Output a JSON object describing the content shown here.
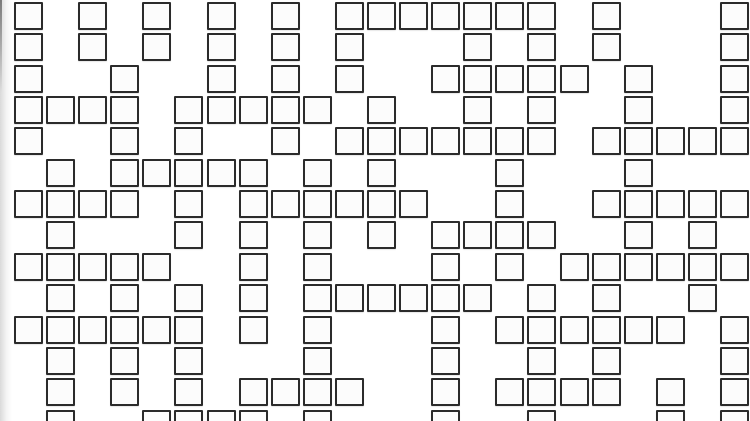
{
  "page": {
    "background_color": "#ffffff",
    "left_shadow_color": "#787878",
    "width": 750,
    "height": 421
  },
  "grid": {
    "rows": 14,
    "cols": 23,
    "origin_x": 14,
    "origin_y": 2,
    "pitch_x": 32.09,
    "pitch_y": 31.35,
    "cell_width": 29,
    "cell_height": 28,
    "border_width": 2,
    "border_color": "#2b2b2b",
    "cell_fill": "#fcfcfc",
    "cells_by_row": [
      [
        0,
        2,
        4,
        6,
        8,
        10,
        11,
        12,
        13,
        14,
        15,
        16,
        18,
        22
      ],
      [
        0,
        2,
        4,
        6,
        8,
        10,
        14,
        16,
        18,
        22
      ],
      [
        0,
        3,
        6,
        8,
        10,
        13,
        14,
        15,
        16,
        17,
        19,
        22
      ],
      [
        0,
        1,
        2,
        3,
        5,
        6,
        7,
        8,
        9,
        11,
        14,
        16,
        19,
        22
      ],
      [
        0,
        3,
        5,
        8,
        10,
        11,
        12,
        13,
        14,
        15,
        16,
        18,
        19,
        20,
        21,
        22
      ],
      [
        1,
        3,
        4,
        5,
        6,
        7,
        9,
        11,
        15,
        19
      ],
      [
        0,
        1,
        2,
        3,
        5,
        7,
        8,
        9,
        10,
        11,
        12,
        15,
        18,
        19,
        20,
        21,
        22
      ],
      [
        1,
        5,
        7,
        9,
        11,
        13,
        14,
        15,
        16,
        19,
        21
      ],
      [
        0,
        1,
        2,
        3,
        4,
        7,
        9,
        13,
        15,
        17,
        18,
        19,
        20,
        21,
        22
      ],
      [
        1,
        3,
        5,
        7,
        9,
        10,
        11,
        12,
        13,
        14,
        16,
        18,
        21
      ],
      [
        0,
        1,
        2,
        3,
        4,
        5,
        7,
        9,
        13,
        15,
        16,
        17,
        18,
        19,
        20,
        22
      ],
      [
        1,
        3,
        5,
        9,
        13,
        16,
        18,
        22
      ],
      [
        1,
        3,
        5,
        7,
        8,
        9,
        10,
        13,
        15,
        16,
        17,
        18,
        20,
        22
      ],
      [
        1,
        4,
        5,
        6,
        7,
        9,
        13,
        16,
        20,
        22
      ]
    ]
  }
}
